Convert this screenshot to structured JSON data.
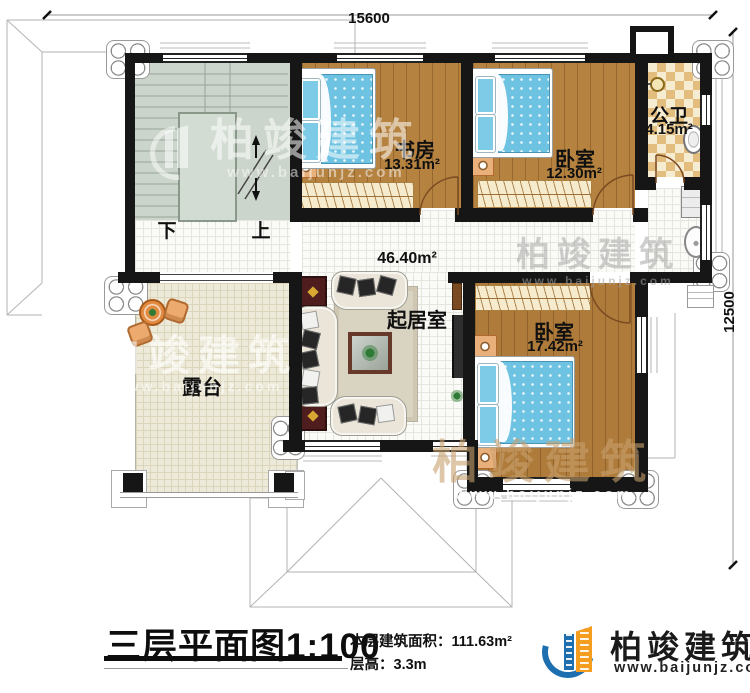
{
  "dimensions": {
    "top": "15600",
    "right": "12500"
  },
  "rooms": {
    "study": {
      "name": "书房",
      "area": "13.31m²"
    },
    "bedroom_top": {
      "name": "卧室",
      "area": "12.30m²"
    },
    "bathroom": {
      "name": "公卫",
      "area": "4.15m²"
    },
    "living": {
      "name": "起居室",
      "area": "46.40m²"
    },
    "bedroom_bottom": {
      "name": "卧室",
      "area": "17.42m²"
    },
    "terrace": {
      "name": "露台"
    }
  },
  "stairs": {
    "down": "下",
    "up": "上"
  },
  "watermark": {
    "brand": "柏竣建筑",
    "site": "www.baijunjz.com"
  },
  "footer": {
    "title": "三层平面图1:100",
    "area_label": "本层建筑面积：",
    "area_value": "111.63m²",
    "height_label": "层高：",
    "height_value": "3.3m",
    "brand": "柏竣建筑",
    "site": "www.baijunjz.com"
  },
  "colors": {
    "wall": "#161616",
    "wood": "#b5823f",
    "stair_floor": "#ccd5cb",
    "bath_tile": "#e2bd7e",
    "bed_blue": "#6fc3e2",
    "logo_blue": "#1d6fb0",
    "logo_orange": "#f59d1f"
  }
}
